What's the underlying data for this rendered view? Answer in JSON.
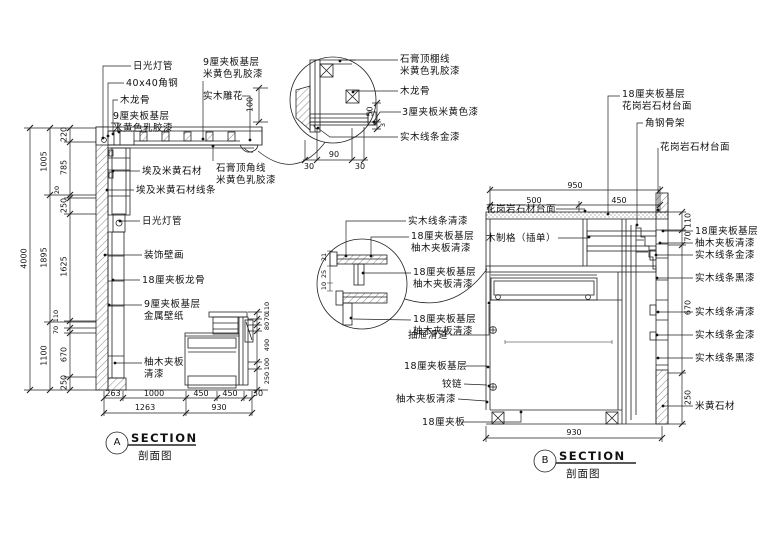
{
  "section_a": {
    "marker": {
      "letter": "A",
      "title": "SECTION",
      "subtitle": "剖面图"
    },
    "callouts": [
      {
        "l1": "日光灯管"
      },
      {
        "l1": "40x40角钢"
      },
      {
        "l1": "木龙骨"
      },
      {
        "l1": "9厘夹板基层",
        "l2": "米黄色乳胶漆"
      },
      {
        "l1": "9厘夹板基层",
        "l2": "米黄色乳胶漆"
      },
      {
        "l1": "实木雕花"
      },
      {
        "l1": "石膏顶角线",
        "l2": "米黄色乳胶漆"
      },
      {
        "l1": "埃及米黄石材"
      },
      {
        "l1": "埃及米黄石材线条"
      },
      {
        "l1": "日光灯管"
      },
      {
        "l1": "装饰壁画"
      },
      {
        "l1": "18厘夹板龙骨"
      },
      {
        "l1": "9厘夹板基层",
        "l2": "金属壁纸"
      },
      {
        "l1": "柚木夹板",
        "l2": "清漆"
      }
    ],
    "dim_total": "4000",
    "dims_mid": [
      "1005",
      "1895",
      "1100"
    ],
    "dims_inner": [
      "220",
      "785",
      "20",
      "250",
      "1625",
      "110",
      "70",
      "670",
      "250"
    ],
    "dims_cabinet": [
      "110",
      "70",
      "80",
      "490",
      "100",
      "250"
    ],
    "dims_bottom_upper": [
      "263",
      "1000",
      "450",
      "450",
      "30"
    ],
    "dims_bottom_lower": [
      "1263",
      "930"
    ]
  },
  "detail_a": {
    "callouts": [
      {
        "l1": "石膏顶棚线",
        "l2": "米黄色乳胶漆"
      },
      {
        "l1": "木龙骨"
      },
      {
        "l1": "3厘夹板米黄色漆"
      },
      {
        "l1": "实木线条金漆"
      }
    ],
    "dims_vertical": [
      "100",
      "50",
      "3"
    ],
    "dims_horizontal": [
      "90",
      "30",
      "30"
    ]
  },
  "section_b": {
    "marker": {
      "letter": "B",
      "title": "SECTION",
      "subtitle": "剖面图"
    },
    "callouts_top": [
      {
        "l1": "18厘夹板基层",
        "l2": "花岗岩石材台面"
      },
      {
        "l1": "角钢骨架"
      },
      {
        "l1": "花岗岩石材台面"
      }
    ],
    "callouts_left": [
      {
        "l1": "花岗岩石材台面"
      },
      {
        "l1": "木制格（插单）"
      },
      {
        "l1": "抽屉滑道"
      },
      {
        "l1": "18厘夹板基层"
      },
      {
        "l1": "铰链"
      },
      {
        "l1": "柚木夹板清漆"
      },
      {
        "l1": "18厘夹板"
      }
    ],
    "callouts_right": [
      {
        "l1": "18厘夹板基层"
      },
      {
        "l1": "柚木夹板清漆"
      },
      {
        "l1": "实木线条金漆"
      },
      {
        "l1": "实木线条黑漆"
      },
      {
        "l1": "实木线条清漆"
      },
      {
        "l1": "实木线条金漆"
      },
      {
        "l1": "实木线条黑漆"
      },
      {
        "l1": "米黄石材"
      }
    ],
    "dims_top": [
      "950",
      "500",
      "450"
    ],
    "dims_right": [
      "110",
      "70",
      "670",
      "250"
    ],
    "dim_bottom": "930"
  },
  "detail_b": {
    "callouts": [
      {
        "l1": "实木线条清漆"
      },
      {
        "l1": "18厘夹板基层",
        "l2": "柚木夹板清漆"
      },
      {
        "l1": "18厘夹板基层",
        "l2": "柚木夹板清漆"
      },
      {
        "l1": "18厘夹板基层",
        "l2": "柚木夹板清漆"
      }
    ],
    "dims": [
      "21",
      "25",
      "10"
    ]
  }
}
